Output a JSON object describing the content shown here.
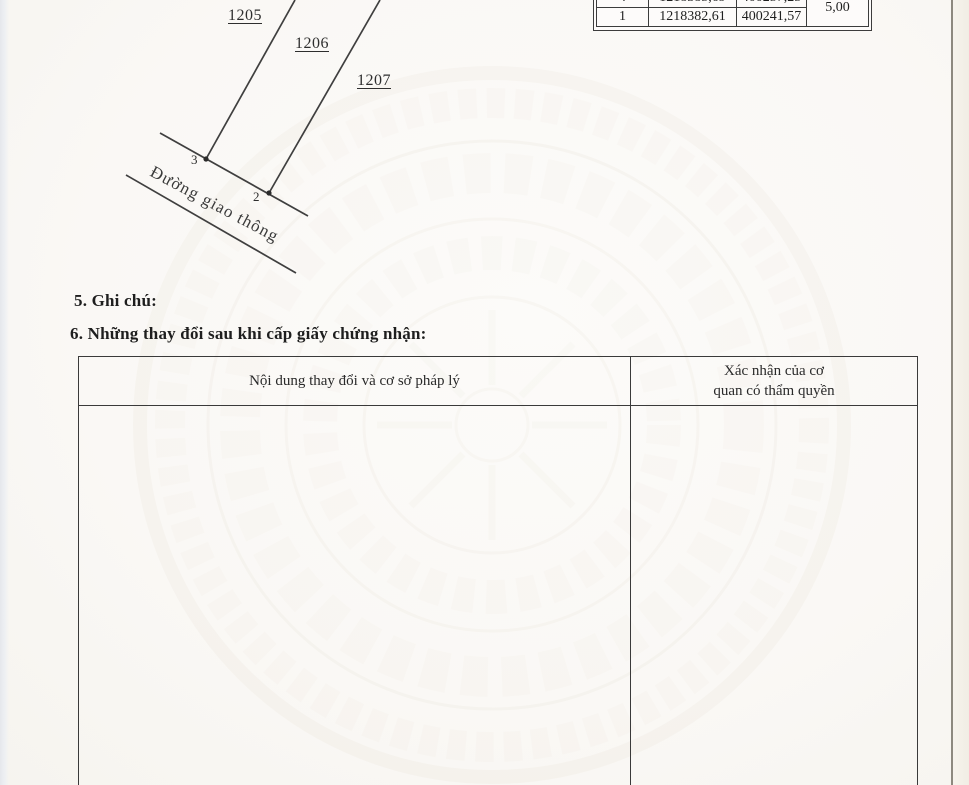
{
  "document": {
    "coordinate_table": {
      "clipped_row": {
        "point_no": "4",
        "x_coord": "1218385,69",
        "y_coord": "400257,25"
      },
      "row1": {
        "point_no": "1",
        "x_coord": "1218382,61",
        "y_coord": "400241,57"
      },
      "side_value": "5,00"
    },
    "sketch": {
      "parcel_1205": "1205",
      "parcel_1206": "1206",
      "parcel_1207": "1207",
      "vertex_3": "3",
      "vertex_2": "2",
      "road_label": "Đường giao thông"
    },
    "section5_heading": "5. Ghi chú:",
    "section6_heading": "6. Những thay đổi sau khi cấp giấy chứng nhận:",
    "changes_table": {
      "col1_header": "Nội dung thay đổi và cơ sở pháp lý",
      "col2_header_line1": "Xác nhận của cơ",
      "col2_header_line2": "quan có thẩm quyền"
    }
  },
  "colors": {
    "paper": "#fbfaf8",
    "ink": "#262626",
    "table_border": "#3c3c3c",
    "watermark": "#cdc1aa"
  }
}
